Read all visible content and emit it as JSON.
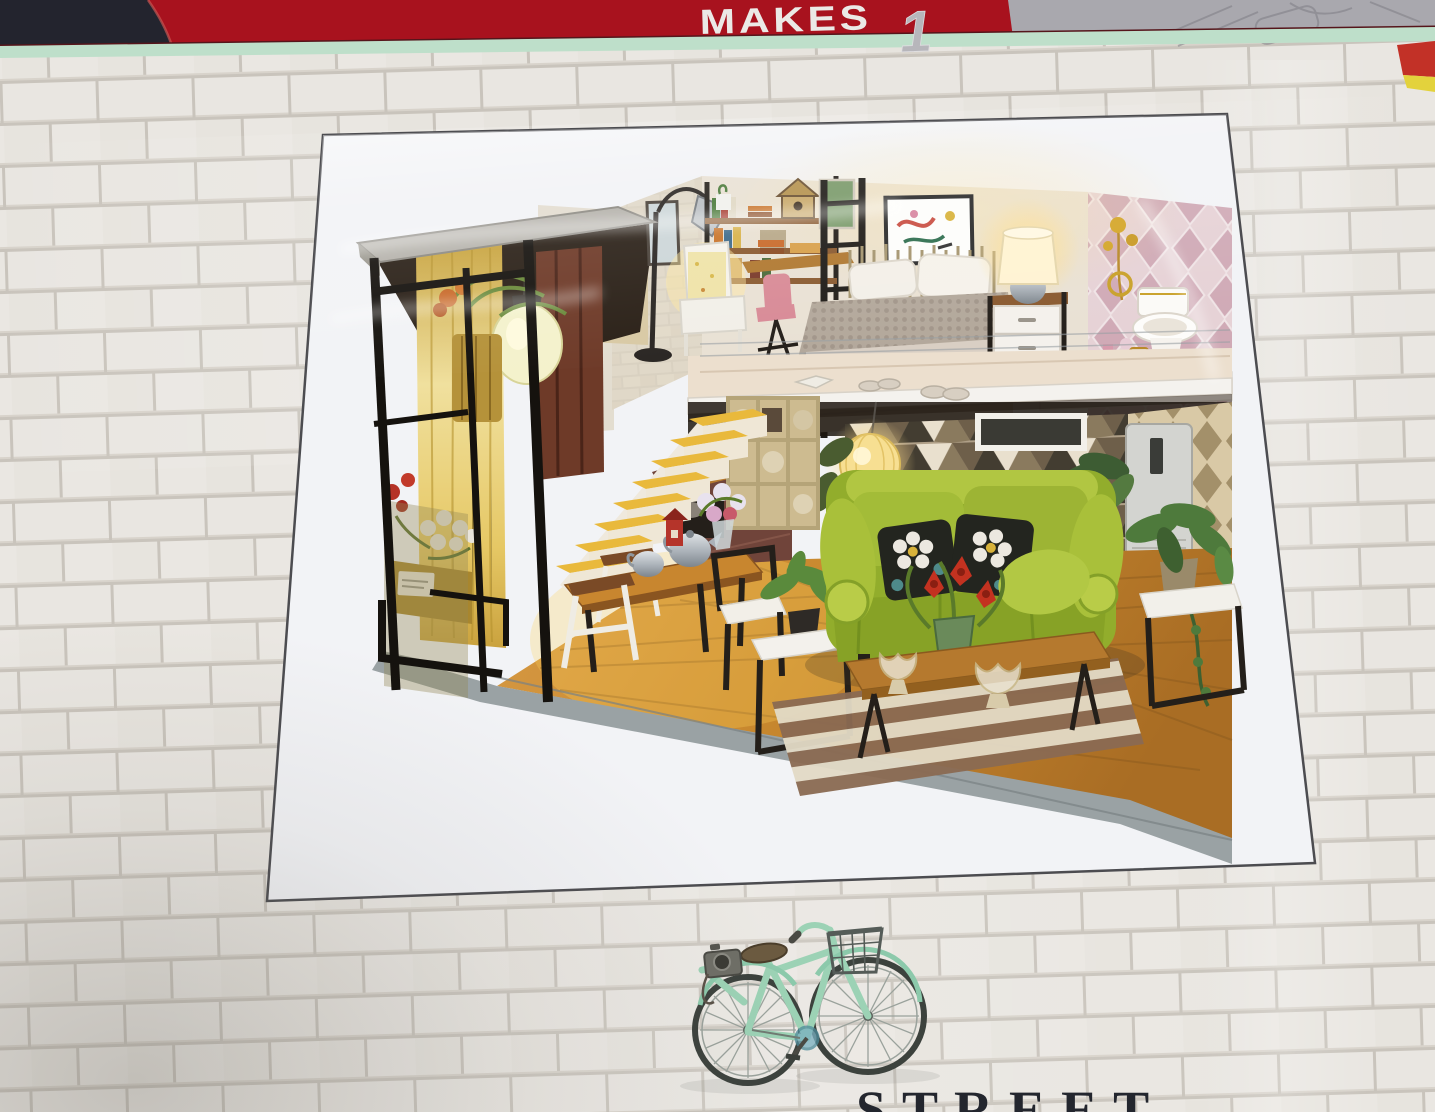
{
  "scene_description": "DIY miniature dollhouse kit box photographed on a white painted-brick shelf display",
  "top_banner": {
    "makes_label": "MAKES",
    "makes_quantity": "1",
    "banner_red": "#a8121e",
    "corner_navy": "#23242e",
    "right_panel_gray": "#a9a8ae",
    "label_color": "#ebe9e6",
    "quantity_color": "#b7b6bb",
    "edge_flag_red": "#c23127",
    "edge_flag_yellow": "#e3d23c"
  },
  "box_face": {
    "stripe_mint": "#bedfca",
    "brick_color": "#e9e6e1",
    "mortar_color": "#c9c4bc"
  },
  "photo_print": {
    "paper_color": "#f2f3f6",
    "border_color": "#4c4c50",
    "scene": "lit miniature loft apartment diorama",
    "elements": [
      "concrete-top pergola",
      "pendant lamp",
      "yellow curtains",
      "flower planters",
      "staircase with yellow treads",
      "dining table with silver teapots",
      "stools",
      "cube shelving with baskets",
      "loft bed with knit blanket",
      "abstract wall art",
      "nightstand with lit lamp",
      "pink harlequin bathroom wall",
      "toilet with gold trim",
      "gold flower decor",
      "triangle pattern wallpaper",
      "glowing paper lantern",
      "green sofa with floral pillows",
      "potted plants",
      "wood coffee table with red flowers",
      "striped rug",
      "air conditioner cabinet",
      "reading nook bookshelf",
      "floor lamp",
      "white armchair",
      "birdhouse",
      "wood plank floor"
    ]
  },
  "footer": {
    "bicycle_description": "mint green bicycle with wire front basket and camera on rear rack",
    "bicycle_frame_color": "#9cd2b5",
    "partial_text": "STREET",
    "partial_text_color": "#23262e"
  }
}
